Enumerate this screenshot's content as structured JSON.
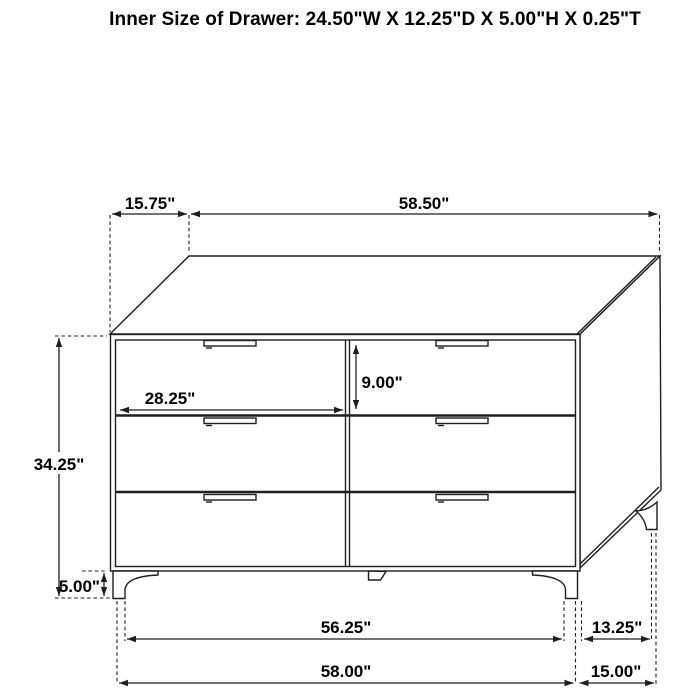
{
  "title": "Inner Size of Drawer: 24.50\"W X 12.25\"D X 5.00\"H X 0.25\"T",
  "colors": {
    "line": "#1f1f1f",
    "text": "#000000",
    "background": "#ffffff"
  },
  "dims": {
    "top_offset": "15.75\"",
    "top_width": "58.50\"",
    "drawer_width": "28.25\"",
    "drawer_height": "9.00\"",
    "overall_height": "34.25\"",
    "leg_height": "5.00\"",
    "foot_span_width": "56.25\"",
    "foot_span_depth": "13.25\"",
    "overall_width": "58.00\"",
    "overall_depth": "15.00\""
  }
}
